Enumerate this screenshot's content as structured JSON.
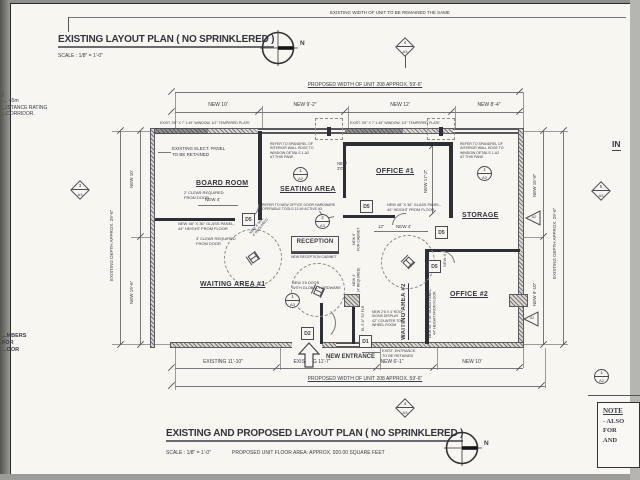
{
  "sheet": {
    "top_note": "EXISTING WIDTH OF UNIT TO BE REMAINED THE SAME",
    "in_label": "IN",
    "north": "N"
  },
  "titles": {
    "existing_title": "EXISTING LAYOUT PLAN ( NO SPRINKLERED )",
    "existing_scale": "SCALE : 1/8\" = 1'-0\"",
    "proposed_title": "EXISTING AND PROPOSED LAYOUT PLAN ( NO SPRINKLERED )",
    "proposed_scale": "SCALE : 1/8\" = 1'-0\"",
    "proposed_area": "PROPOSED UNIT FLOOR AREA: APPROX. 920.00 SQUARE FEET"
  },
  "margin": {
    "left_top": ")\n..., 45m\n...ISTANCE RATING\n...CORRIDOR.",
    "left_bottom": "...MBERS\nFOR\n...OOR",
    "note_title": "NOTE",
    "note_lines": "- ALSO\nFOR\nAND"
  },
  "rooms": {
    "board": "BOARD ROOM",
    "seating": "SEATING AREA",
    "office1": "OFFICE #1",
    "storage": "STORAGE",
    "reception": "RECEPTION",
    "waiting1": "WAITING AREA #1",
    "waiting2": "WAITING AREA #2",
    "office2": "OFFICE #2",
    "new_entrance": "NEW ENTRANCE"
  },
  "dims": {
    "top_overall": "PROPOSED WIDTH OF UNIT 208 APPROX. 59'-6\"",
    "top_seg1": "NEW 10'",
    "top_seg2": "NEW 9'-2\"",
    "top_seg3": "NEW 12'",
    "top_seg4": "NEW 8'-4\"",
    "bottom_seg1": "EXISTING 11'-10\"",
    "bottom_seg2": "EXISTING 11'-7\"",
    "bottom_seg3": "NEW 6'-1\"",
    "bottom_seg4": "NEW 10'",
    "bottom_overall": "PROPOSED WIDTH OF UNIT 208 APPROX. 59'-6\"",
    "left_overall": "EXISTING DEPTH APPROX. 29'-6\"",
    "left_seg1": "NEW 10'",
    "left_seg2": "NEW 19'-6\"",
    "right_seg1": "NEW 15'-8\"",
    "right_seg2": "NEW 9'-10\"",
    "right_overall": "EXISTING DEPTH APPROX. 29'-6\"",
    "office1_depth": "NEW 17'-2\"",
    "door_board": "NEW 4'",
    "door_office1": "NEW 4'",
    "twelve": "12\"",
    "door_30": "NEW\n3'0\"",
    "cabinet6": "NEW 6'\nFOR CABINET",
    "wall4": "NEW 4'\n(4' REQUIRED)",
    "diag4": "NEW 4' MIN.\n4' REQUIRED",
    "storage4": "NEW 4'",
    "counter_el": "EL 3'-6\" TO FLR"
  },
  "notes": {
    "window1": "EXIST. 3'6\" X 7' 1.49\" WINDOW, 1/2\" TEMPERED PLATE",
    "window2": "EXIST. 3'6\" X 7' 1.49\" WINDOW, 1/2\" TEMPERED PLATE",
    "elect_panel": "EXISTING ELECT. PANEL\nTO BE RETAINED",
    "clear2": "2' CLEAR REQUIRED\nFROM DOOR",
    "clear3": "3' CLEAR REQUIRED\nFROM DOOR",
    "glass_board": "NEW 48\" X 36\" GLASS PANEL,\n44\" HEIGHT FROM FLOOR",
    "glass_office1": "NEW 48\" X 36\" GLASS PANEL,\n44\" HEIGHT FROM FLOOR",
    "glass_waiting2": "NEW 48\" X 36\" GLASS PANEL,\n44\" HEIGHT FROM FLOOR",
    "spandrel1": "REFER TO SPANDREL OF\nINTERIOR WALL EDGE TO\nWINDOW DETAILS 1-A2\nAT THIS PANE",
    "spandrel2": "REFER TO SPANDREL OF\nINTERIOR WALL EDGE TO\nWINDOW DETAILS 1-A2\nAT THIS PANE",
    "door_hardware": "REFER TO NEW OFFICE DOOR HARDWARE\nOPERABLE TOOLS 13-49 ACTIVE A3",
    "reception_cabinet": "NEW RECEPTION CABINET",
    "door_36": "NEW 3'6 DOOR\nWITH GLOBAL HARDWARE",
    "sign_display": "NEW 2'6 X 4' ROOF\nSIGNS DISPLAY\n42\" COUNTER TOP,\nWHEEL ROOM",
    "exist_entrance": "EXIST. ENTRANCE\nTO BE RETAINED"
  },
  "tags": {
    "d5": "D5",
    "d2": "D2",
    "d1": "D1",
    "a2": "A2",
    "c_1a2": {
      "num": "1",
      "sheet": "A2"
    },
    "c_2a3": {
      "num": "2",
      "sheet": "A3"
    },
    "c_1a3": {
      "num": "1",
      "sheet": "A3"
    },
    "dm_3a3": {
      "num": "3",
      "sheet": "A3"
    },
    "dm_4a3": {
      "num": "4",
      "sheet": "A3"
    },
    "dm_5a3": {
      "num": "5",
      "sheet": "A3"
    }
  }
}
